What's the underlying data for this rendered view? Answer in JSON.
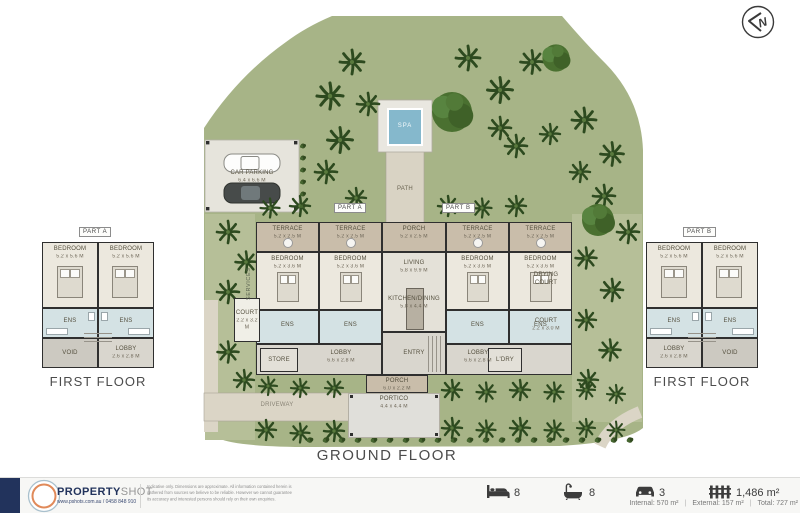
{
  "compass": {
    "letter": "N"
  },
  "titles": {
    "ground_floor": "GROUND FLOOR",
    "first_floor": "FIRST FLOOR"
  },
  "site": {
    "spa": "SPA",
    "path": "PATH",
    "driveway": "DRIVEWAY",
    "car_parking": {
      "name": "CAR PARKING",
      "dims": "6.4 x 6.6 M"
    },
    "part_a": "PART A",
    "part_b": "PART B"
  },
  "ground": {
    "terrace": {
      "name": "TERRACE",
      "dims": "5.2 x 2.5 M"
    },
    "bedroom": {
      "name": "BEDROOM",
      "dims": "5.2 x 3.6 M"
    },
    "ens": "ENS",
    "porch_top": {
      "name": "PORCH",
      "dims": "5.2 x 2.5 M"
    },
    "living": {
      "name": "LIVING",
      "dims": "5.8 x 9.9 M"
    },
    "kitchen": {
      "name": "KITCHEN/DINING",
      "dims": "5.8 x 4.4 M"
    },
    "entry": "ENTRY",
    "lobby": {
      "name": "LOBBY",
      "dims": "6.6 x 2.8 M"
    },
    "store": "STORE",
    "laundry": "L'DRY",
    "court_left": {
      "name": "COURT",
      "dims": "2.2 x 3.2 M"
    },
    "court_right": {
      "name": "COURT",
      "dims": "2.2 x 3.0 M"
    },
    "services": "SERVICES",
    "drying_court": {
      "line1": "DRYING",
      "line2": "COURT"
    },
    "porch_bottom": {
      "name": "PORCH",
      "dims": "6.0 x 2.2 M"
    },
    "portico": {
      "name": "PORTICO",
      "dims": "4.4 x 4.4 M"
    }
  },
  "first": {
    "bedroom": {
      "name": "BEDROOM",
      "dims": "5.2 x 5.6 M"
    },
    "ens": "ENS",
    "void": "VOID",
    "lobby": {
      "name": "LOBBY",
      "dims": "2.6 x 2.8 M"
    }
  },
  "footer": {
    "brand_bold": "PROPERTY",
    "brand_light": "SHOT",
    "brand_sub": "www.pshots.com.au / 0458 848 910",
    "disclaimer_1": "Indicative only.  Dimensions are approximate.  All information contained herein is",
    "disclaimer_2": "gathered from sources we believe to be reliable.  However we cannot guarantee",
    "disclaimer_3": "its accuracy and interested persons should rely on their own enquiries.",
    "beds": "8",
    "baths": "8",
    "cars": "3",
    "land_area": "1,486 m²",
    "internal": "Internal: 570 m²",
    "external": "External: 157 m²",
    "total": "Total: 727 m²",
    "separator": "|"
  },
  "colors": {
    "accent_navy": "#22335c",
    "logo_orange": "#e08a5a",
    "site_green": "#a7b487",
    "water_blue": "#85b8cc"
  }
}
